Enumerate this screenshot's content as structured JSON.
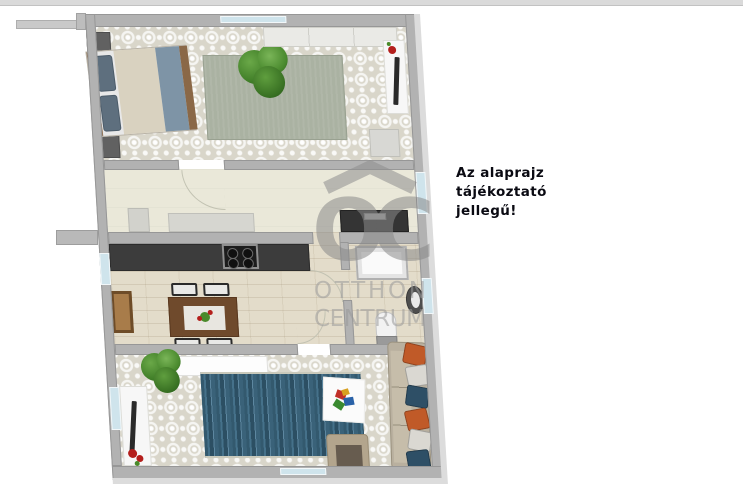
{
  "note": {
    "line1": "Az alaprajz",
    "line2": "tájékoztató",
    "line3": "jellegű!"
  },
  "watermark": {
    "brand_initials": "OC",
    "brand_line1": "OTTHON",
    "brand_line2": "CENTRUM"
  },
  "colors": {
    "wall": "#b2b2b2",
    "wall_highlight": "#dcdcdc",
    "window_glass": "#cfe4ec",
    "tile_floor": "#d9d6ca",
    "hall_floor": "#eae8d9",
    "wood_floor": "#e3dcca",
    "counter_dark": "#3c3c3c",
    "rug_bedroom": "#aab2a2",
    "rug_living": "#3c657b",
    "bed_duvet": "#d9d2c0",
    "bed_runner": "#7e94a6",
    "couch_body": "#b9b09f",
    "pillow_orange": "#c05a28",
    "pillow_blue": "#2e4f66",
    "accent_red": "#b41f1c",
    "plant_green": "#4a8a2a",
    "watermark_gray": "#8f8f8f",
    "note_text": "#0a0a12"
  },
  "plan": {
    "rooms": [
      {
        "name": "bedroom",
        "floor": "patterned-tile"
      },
      {
        "name": "hallway",
        "floor": "plain-beige"
      },
      {
        "name": "kitchen-dining",
        "floor": "light-wood"
      },
      {
        "name": "bathroom",
        "floor": "light-wood"
      },
      {
        "name": "living-room",
        "floor": "patterned-tile"
      }
    ],
    "furniture": [
      "double-bed",
      "nightstand",
      "nightstand",
      "bedroom-rug",
      "plant",
      "wardrobe",
      "tv-console",
      "pouf",
      "doormat",
      "hall-bench",
      "washing-machine",
      "kitchen-counter",
      "stove",
      "dining-table",
      "chair",
      "chair",
      "chair",
      "chair",
      "brown-cabinet",
      "shower",
      "sink",
      "toilet",
      "sideboard",
      "plant",
      "tv-console",
      "living-rug",
      "play-mat",
      "armchair",
      "sofa"
    ]
  }
}
